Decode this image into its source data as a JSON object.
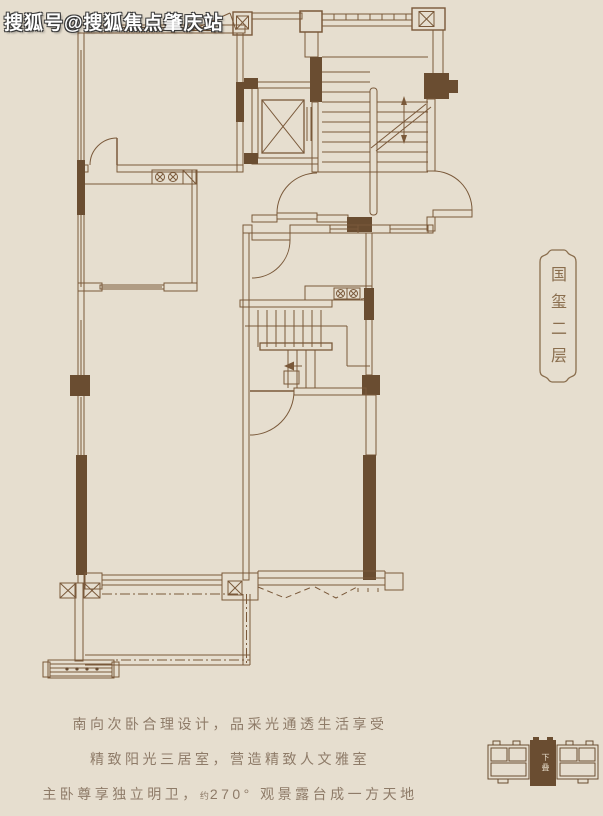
{
  "watermark": {
    "text": "搜狐号@搜狐焦点肇庆站"
  },
  "plaque": {
    "text": "国玺二层"
  },
  "taglines": {
    "line1": "南向次卧合理设计，品采光通透生活享受",
    "line2": "精致阳光三居室，营造精致人文雅室",
    "line3_prefix": "主卧尊享独立明卫，",
    "line3_small": "约",
    "line3_suffix": "270° 观景露台成一方天地"
  },
  "keyplan": {
    "label": "下叠"
  },
  "colors": {
    "background": "#e6decf",
    "plan_line": "#7a593a",
    "wall_fill": "#6a4d31",
    "tagline_text": "#8e7b68",
    "plaque_text": "#8a6e4e",
    "watermark_text": "#ffffff"
  }
}
